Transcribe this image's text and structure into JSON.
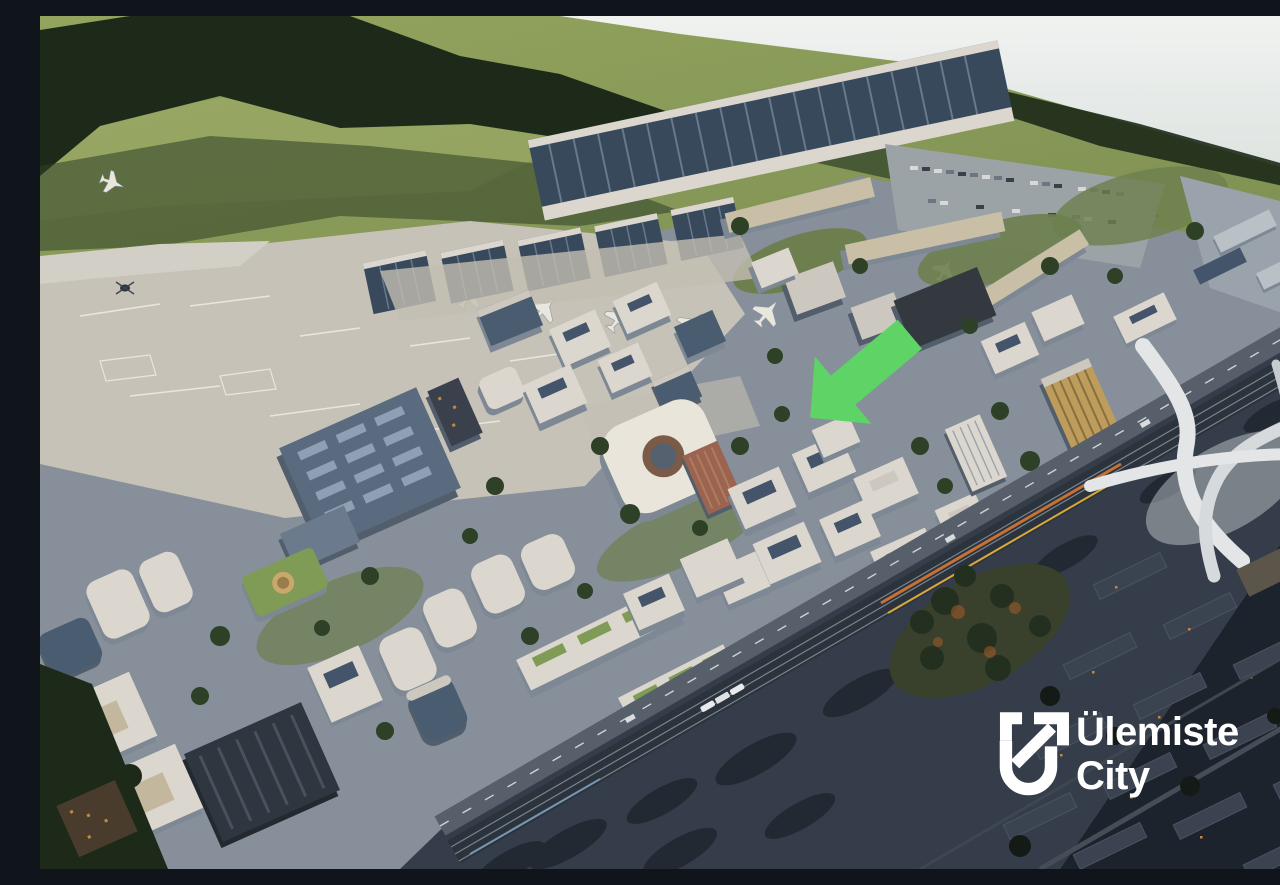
{
  "image": {
    "alt": "Aerial rendering of the Ülemiste City smart business campus beside Tallinn Airport, with a lake on the horizon, airport terminal and apron at top left, a dense office district in the centre, and a rail corridor crossing the lower right",
    "width_px": 1280,
    "height_px": 853
  },
  "branding": {
    "logo_line1": "Ülemiste",
    "logo_line2": "City",
    "logo_color": "#ffffff"
  },
  "marker": {
    "shape": "arrow",
    "direction": "down-left",
    "color": "#5dd465"
  },
  "palette": {
    "water_haze": "#edf0ee",
    "field_green": "#8a9a5e",
    "forest_dark": "#25331f",
    "apron_concrete": "#c6c2b8",
    "terminal_roof": "#3a4856",
    "district_ground": "#87909a",
    "corridor_asphalt": "#343d49",
    "night_city": "#1c232c"
  }
}
